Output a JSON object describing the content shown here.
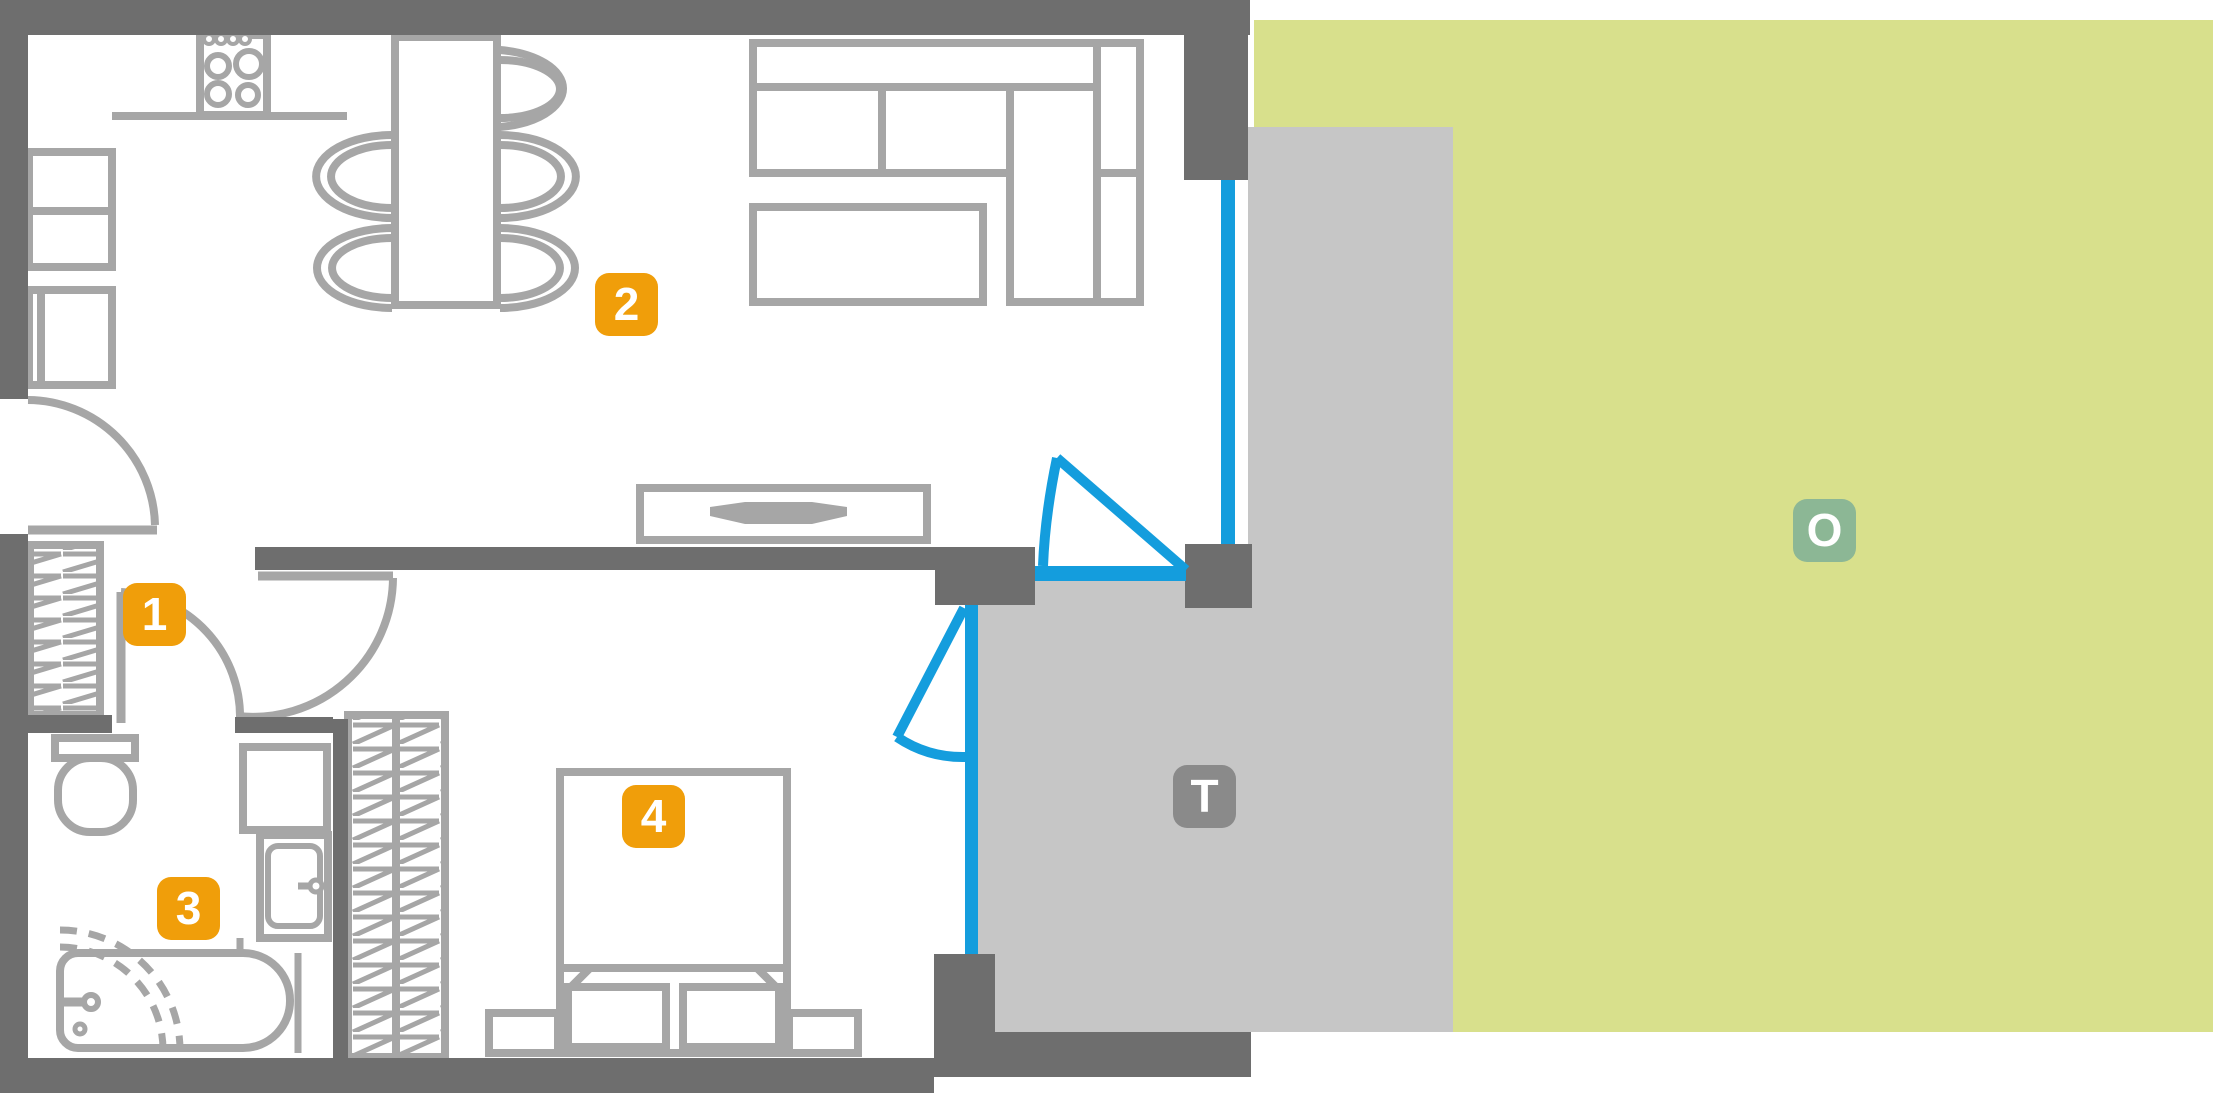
{
  "page": {
    "title": "Apartment floor plan with terrace and garden"
  },
  "markers": {
    "hall": {
      "text": "1",
      "color": "#f09e0a"
    },
    "living": {
      "text": "2",
      "color": "#f09e0a"
    },
    "bathroom": {
      "text": "3",
      "color": "#f09e0a"
    },
    "bedroom": {
      "text": "4",
      "color": "#f09e0a"
    },
    "terrace": {
      "text": "T",
      "color": "#8a8a8a"
    },
    "outdoor": {
      "text": "O",
      "color": "#8cb795"
    }
  },
  "colors": {
    "walls": "#6e6e6e",
    "furniture_lines": "#a6a6a6",
    "terrace_floor": "#c6c6c6",
    "garden": "#d8e08c",
    "glazing_blue": "#149ddd",
    "marker_orange": "#f09e0a",
    "marker_gray": "#8a8a8a",
    "marker_green": "#8cb795",
    "background": "#ffffff"
  }
}
